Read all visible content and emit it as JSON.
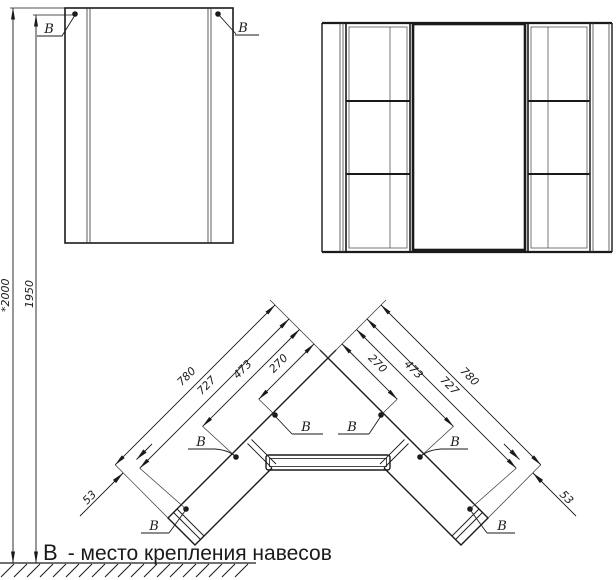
{
  "drawing": {
    "mount_symbol": "В",
    "legend_symbol": "В",
    "legend_text": "- место крепления навесов",
    "heights": {
      "overall": "*2000",
      "mount": "1950"
    },
    "plan": {
      "dims_left": [
        "780",
        "727",
        "473",
        "270"
      ],
      "dims_right": [
        "780",
        "727",
        "473",
        "270"
      ],
      "end_offset_left": "53",
      "end_offset_right": "53"
    }
  }
}
